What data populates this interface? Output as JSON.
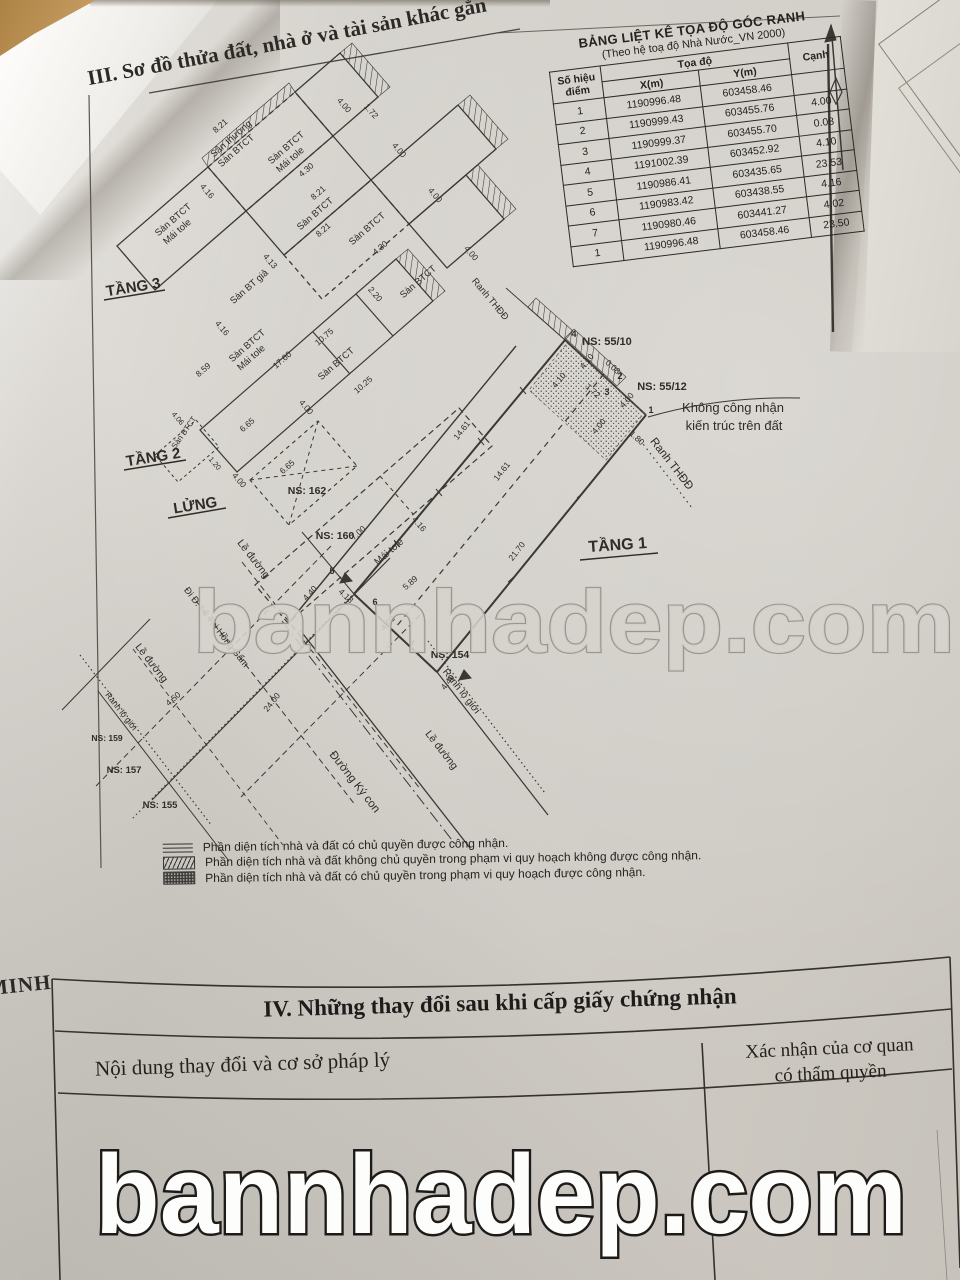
{
  "document": {
    "section3_title": "III. Sơ đồ thửa đất, nhà ở và tài sản khác gắn",
    "side_text": "MINH"
  },
  "coord_table": {
    "title": "BẢNG LIỆT KÊ TỌA ĐỘ GÓC RANH",
    "subtitle": "(Theo hệ toạ độ Nhà Nước_VN 2000)",
    "col_point_1": "Số hiệu",
    "col_point_2": "điểm",
    "col_coord": "Tọa độ",
    "col_x": "X(m)",
    "col_y": "Y(m)",
    "col_edge": "Cạnh",
    "rows": [
      {
        "pt": "1",
        "x": "1190996.48",
        "y": "603458.46",
        "c": ""
      },
      {
        "pt": "2",
        "x": "1190999.43",
        "y": "603455.76",
        "c": "4.00"
      },
      {
        "pt": "3",
        "x": "1190999.37",
        "y": "603455.70",
        "c": "0.08"
      },
      {
        "pt": "4",
        "x": "1191002.39",
        "y": "603452.92",
        "c": "4.10"
      },
      {
        "pt": "5",
        "x": "1190986.41",
        "y": "603435.65",
        "c": "23.53"
      },
      {
        "pt": "6",
        "x": "1190983.42",
        "y": "603438.55",
        "c": "4.16"
      },
      {
        "pt": "7",
        "x": "1190980.46",
        "y": "603441.27",
        "c": "4.02"
      },
      {
        "pt": "1",
        "x": "1190996.48",
        "y": "603458.46",
        "c": "23.50"
      }
    ]
  },
  "diagram": {
    "labels": [
      {
        "t": "TẦNG 3",
        "x": 134,
        "y": 292,
        "r": -9,
        "s": 15,
        "b": 1,
        "n": "floor-label-tang3"
      },
      {
        "t": "TẦNG 2",
        "x": 154,
        "y": 462,
        "r": -9,
        "s": 15,
        "b": 1,
        "n": "floor-label-tang2"
      },
      {
        "t": "LỬNG",
        "x": 196,
        "y": 510,
        "r": -9,
        "s": 15,
        "b": 1,
        "n": "floor-label-lung"
      },
      {
        "t": "TẦNG 1",
        "x": 618,
        "y": 550,
        "r": -4,
        "s": 16,
        "b": 1,
        "n": "floor-label-tang1"
      },
      {
        "t": "Sân thượng",
        "x": 233,
        "y": 141,
        "r": -41,
        "s": 9.5
      },
      {
        "t": "Sàn BTCT",
        "x": 238,
        "y": 153,
        "r": -41,
        "s": 9.5
      },
      {
        "t": "Sàn BTCT",
        "x": 288,
        "y": 150,
        "r": -41,
        "s": 9.5
      },
      {
        "t": "Mái tole",
        "x": 292,
        "y": 162,
        "r": -41,
        "s": 9.5
      },
      {
        "t": "Sàn BTCT",
        "x": 175,
        "y": 222,
        "r": -41,
        "s": 9.5
      },
      {
        "t": "Mái tole",
        "x": 179,
        "y": 234,
        "r": -41,
        "s": 9.5
      },
      {
        "t": "Sàn BTCT",
        "x": 317,
        "y": 216,
        "r": -41,
        "s": 9.5
      },
      {
        "t": "Sàn BTCT",
        "x": 369,
        "y": 231,
        "r": -41,
        "s": 9.5
      },
      {
        "t": "Sàn BT giả",
        "x": 251,
        "y": 289,
        "r": -41,
        "s": 9.5
      },
      {
        "t": "Sàn BTCT",
        "x": 420,
        "y": 284,
        "r": -41,
        "s": 9.5
      },
      {
        "t": "Sàn BTCT",
        "x": 249,
        "y": 348,
        "r": -41,
        "s": 9.5
      },
      {
        "t": "Mái tole",
        "x": 253,
        "y": 360,
        "r": -41,
        "s": 9.5
      },
      {
        "t": "Sàn BTCT",
        "x": 338,
        "y": 366,
        "r": -41,
        "s": 9.5
      },
      {
        "t": "Sàn BTCT",
        "x": 186,
        "y": 434,
        "r": -55,
        "s": 8
      },
      {
        "t": "Mái tole",
        "x": 391,
        "y": 554,
        "r": -41,
        "s": 10
      },
      {
        "t": "NS: 55/10",
        "x": 607,
        "y": 345,
        "s": 11,
        "b": 1
      },
      {
        "t": "NS: 55/12",
        "x": 662,
        "y": 390,
        "s": 11,
        "b": 1
      },
      {
        "t": "NS: 162",
        "x": 307,
        "y": 494,
        "s": 10.5,
        "b": 1
      },
      {
        "t": "NS: 160",
        "x": 335,
        "y": 539,
        "s": 10.5,
        "b": 1
      },
      {
        "t": "NS: 154",
        "x": 450,
        "y": 658,
        "s": 10.5,
        "b": 1
      },
      {
        "t": "NS: 159",
        "x": 107,
        "y": 741,
        "s": 8.5,
        "b": 1
      },
      {
        "t": "NS: 157",
        "x": 124,
        "y": 773,
        "s": 9.5,
        "b": 1
      },
      {
        "t": "NS: 155",
        "x": 160,
        "y": 808,
        "s": 9.5,
        "b": 1
      },
      {
        "t": "Không công nhận",
        "x": 733,
        "y": 412,
        "s": 13
      },
      {
        "t": "kiến trúc trên đất",
        "x": 734,
        "y": 430,
        "s": 13
      },
      {
        "t": "Ranh THĐĐ",
        "x": 488,
        "y": 301,
        "r": 50,
        "s": 9.5
      },
      {
        "t": "Ranh THĐĐ",
        "x": 669,
        "y": 466,
        "r": 52,
        "s": 11.5
      },
      {
        "t": "Đường Ký con",
        "x": 352,
        "y": 784,
        "r": 52,
        "s": 11.5
      },
      {
        "t": "Lề đường",
        "x": 251,
        "y": 561,
        "r": 52,
        "s": 10.5
      },
      {
        "t": "Lề đường",
        "x": 149,
        "y": 665,
        "r": 52,
        "s": 10.5
      },
      {
        "t": "Lề đường",
        "x": 439,
        "y": 752,
        "r": 52,
        "s": 10.5
      },
      {
        "t": "Đi Đ. Lê Thị Hồng Gấm",
        "x": 214,
        "y": 629,
        "r": 52,
        "s": 9.5
      },
      {
        "t": "Ranh lộ giới",
        "x": 119,
        "y": 713,
        "r": 52,
        "s": 8.5
      },
      {
        "t": "Ranh lộ giới",
        "x": 459,
        "y": 693,
        "r": 52,
        "s": 10
      },
      {
        "t": "14.61",
        "x": 464,
        "y": 432,
        "r": -52,
        "s": 8.5
      },
      {
        "t": "14.61",
        "x": 504,
        "y": 473,
        "r": -52,
        "s": 8.5
      },
      {
        "t": "21.70",
        "x": 519,
        "y": 553,
        "r": -52,
        "s": 8.5
      },
      {
        "t": "24.00",
        "x": 274,
        "y": 704,
        "r": -52,
        "s": 8.5
      },
      {
        "t": "4.49",
        "x": 450,
        "y": 684,
        "r": -52,
        "s": 8.5
      },
      {
        "t": "4.50",
        "x": 175,
        "y": 701,
        "r": -41,
        "s": 8.5
      },
      {
        "t": "4.40",
        "x": 312,
        "y": 595,
        "r": -48,
        "s": 8.5
      },
      {
        "t": "4.18",
        "x": 344,
        "y": 598,
        "r": 43,
        "s": 8.5
      },
      {
        "t": "4.00",
        "x": 390,
        "y": 625,
        "r": -48,
        "s": 8.5
      },
      {
        "t": "4.10",
        "x": 589,
        "y": 363,
        "r": -50,
        "s": 8.5
      },
      {
        "t": "4.10",
        "x": 561,
        "y": 382,
        "r": -50,
        "s": 8.5
      },
      {
        "t": "0.08",
        "x": 611,
        "y": 369,
        "r": 42,
        "s": 8.5
      },
      {
        "t": "1.72",
        "x": 591,
        "y": 393,
        "r": 42,
        "s": 8.5
      },
      {
        "t": "4.00",
        "x": 629,
        "y": 402,
        "r": -50,
        "s": 8.5
      },
      {
        "t": "4.00",
        "x": 601,
        "y": 428,
        "r": -50,
        "s": 8.5
      },
      {
        "t": "1.80",
        "x": 635,
        "y": 440,
        "r": 42,
        "s": 8.5
      },
      {
        "t": "7.00",
        "x": 360,
        "y": 535,
        "r": -41,
        "s": 8.5
      },
      {
        "t": "4.16",
        "x": 417,
        "y": 526,
        "r": 49,
        "s": 8.5
      },
      {
        "t": "5.89",
        "x": 412,
        "y": 585,
        "r": -41,
        "s": 8.5
      },
      {
        "t": "17.60",
        "x": 284,
        "y": 362,
        "r": -41,
        "s": 8.5
      },
      {
        "t": "10.75",
        "x": 326,
        "y": 339,
        "r": -41,
        "s": 8.5
      },
      {
        "t": "10.25",
        "x": 365,
        "y": 387,
        "r": -41,
        "s": 8.5
      },
      {
        "t": "6.65",
        "x": 249,
        "y": 427,
        "r": -41,
        "s": 8.5
      },
      {
        "t": "6.65",
        "x": 289,
        "y": 469,
        "r": -41,
        "s": 8.5
      },
      {
        "t": "4.00",
        "x": 304,
        "y": 409,
        "r": 49,
        "s": 8.5
      },
      {
        "t": "8.59",
        "x": 205,
        "y": 372,
        "r": -41,
        "s": 8.5
      },
      {
        "t": "4.16",
        "x": 220,
        "y": 330,
        "r": 49,
        "s": 8.5
      },
      {
        "t": "4.00",
        "x": 237,
        "y": 482,
        "r": 49,
        "s": 8.5
      },
      {
        "t": "4.06",
        "x": 176,
        "y": 420,
        "r": 49,
        "s": 7.5
      },
      {
        "t": "1.20",
        "x": 213,
        "y": 465,
        "r": 49,
        "s": 7.5
      },
      {
        "t": "8.21",
        "x": 320,
        "y": 195,
        "r": -41,
        "s": 8.5
      },
      {
        "t": "8.21",
        "x": 325,
        "y": 232,
        "r": -41,
        "s": 8.5
      },
      {
        "t": "8.21",
        "x": 222,
        "y": 128,
        "r": -41,
        "s": 8.5
      },
      {
        "t": "4.30",
        "x": 308,
        "y": 172,
        "r": -41,
        "s": 8.5
      },
      {
        "t": "4.30",
        "x": 382,
        "y": 250,
        "r": -41,
        "s": 8.5
      },
      {
        "t": "4.13",
        "x": 268,
        "y": 263,
        "r": 49,
        "s": 8.5
      },
      {
        "t": "2.20",
        "x": 373,
        "y": 296,
        "r": 49,
        "s": 8.5
      },
      {
        "t": "4.00",
        "x": 342,
        "y": 107,
        "r": 49,
        "s": 8.5
      },
      {
        "t": "4.00",
        "x": 397,
        "y": 152,
        "r": 49,
        "s": 8.5
      },
      {
        "t": "4.00",
        "x": 433,
        "y": 197,
        "r": 49,
        "s": 8.5
      },
      {
        "t": "4.00",
        "x": 469,
        "y": 255,
        "r": 49,
        "s": 8.5
      },
      {
        "t": "1.72",
        "x": 369,
        "y": 113,
        "r": 49,
        "s": 8.5
      },
      {
        "t": "4.16",
        "x": 205,
        "y": 193,
        "r": 49,
        "s": 8.5
      },
      {
        "t": "4",
        "x": 574,
        "y": 337,
        "s": 9,
        "b": 1
      },
      {
        "t": "2",
        "x": 620,
        "y": 379,
        "s": 9,
        "b": 1
      },
      {
        "t": "3",
        "x": 607,
        "y": 395,
        "s": 9,
        "b": 1
      },
      {
        "t": "1",
        "x": 651,
        "y": 413,
        "s": 9,
        "b": 1
      },
      {
        "t": "5",
        "x": 332,
        "y": 574,
        "s": 9,
        "b": 1
      },
      {
        "t": "6",
        "x": 375,
        "y": 605,
        "s": 9,
        "b": 1
      },
      {
        "t": "7",
        "x": 412,
        "y": 647,
        "s": 9,
        "b": 1
      }
    ]
  },
  "legend": {
    "items": [
      {
        "text": "Phần diện tích nhà và đất có chủ quyền được công nhận."
      },
      {
        "text": "Phần diện tích nhà và đất không chủ quyền trong phạm vi quy hoạch không được công nhận."
      },
      {
        "text": "Phần diện tích nhà và đất có chủ quyền trong phạm vi quy hoạch được công nhận."
      }
    ]
  },
  "section4": {
    "title": "IV. Những thay đổi sau khi cấp giấy chứng nhận",
    "col1": "Nội dung thay đổi và cơ sở pháp lý",
    "col2a": "Xác nhận của cơ quan",
    "col2b": "có thẩm quyền"
  },
  "watermark": {
    "text": "bannhadep.com"
  }
}
